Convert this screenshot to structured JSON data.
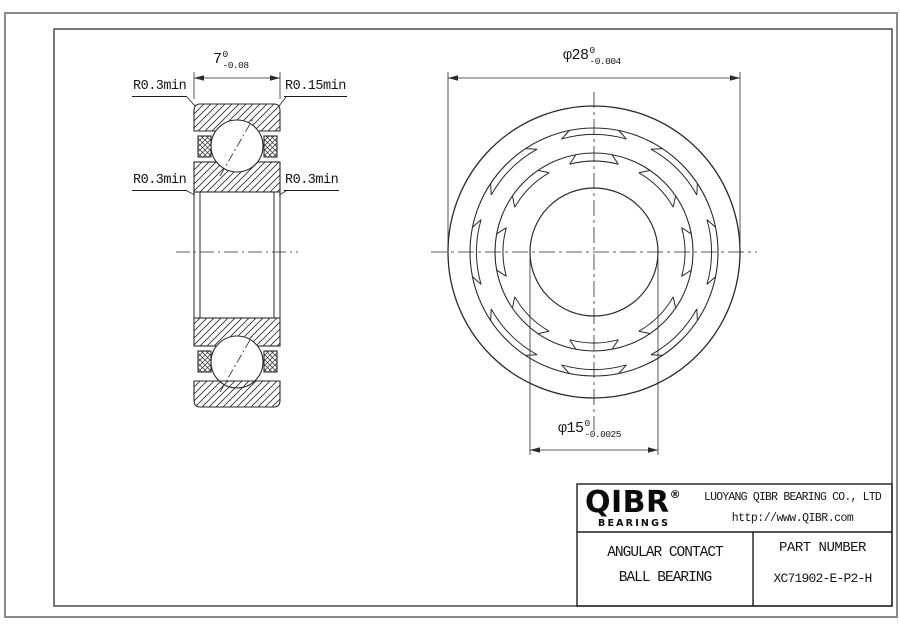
{
  "drawing": {
    "left_view": {
      "width_dim": {
        "value": "7",
        "tol_upper": "0",
        "tol_lower": "-0.08"
      },
      "labels": {
        "top_left": "R0.3min",
        "top_right": "R0.15min",
        "mid_left": "R0.3min",
        "mid_right": "R0.3min"
      }
    },
    "front_view": {
      "outer_dia_dim": {
        "value": "φ28",
        "tol_upper": "0",
        "tol_lower": "-0.004"
      },
      "bore_dia_dim": {
        "value": "φ15",
        "tol_upper": "0",
        "tol_lower": "-0.0025"
      }
    }
  },
  "title_block": {
    "logo_text": "QIBR",
    "logo_reg": "®",
    "logo_subtext": "BEARINGS",
    "company_name": "LUOYANG QIBR BEARING CO., LTD",
    "website": "http://www.QIBR.com",
    "product_line1": "ANGULAR CONTACT",
    "product_line2": "BALL BEARING",
    "part_number_label": "PART NUMBER",
    "part_number": "XC71902-E-P2-H"
  },
  "colors": {
    "line": "#2a2a2a",
    "border_outer": "#8a8a8a",
    "border_inner": "#3f3f3f"
  }
}
